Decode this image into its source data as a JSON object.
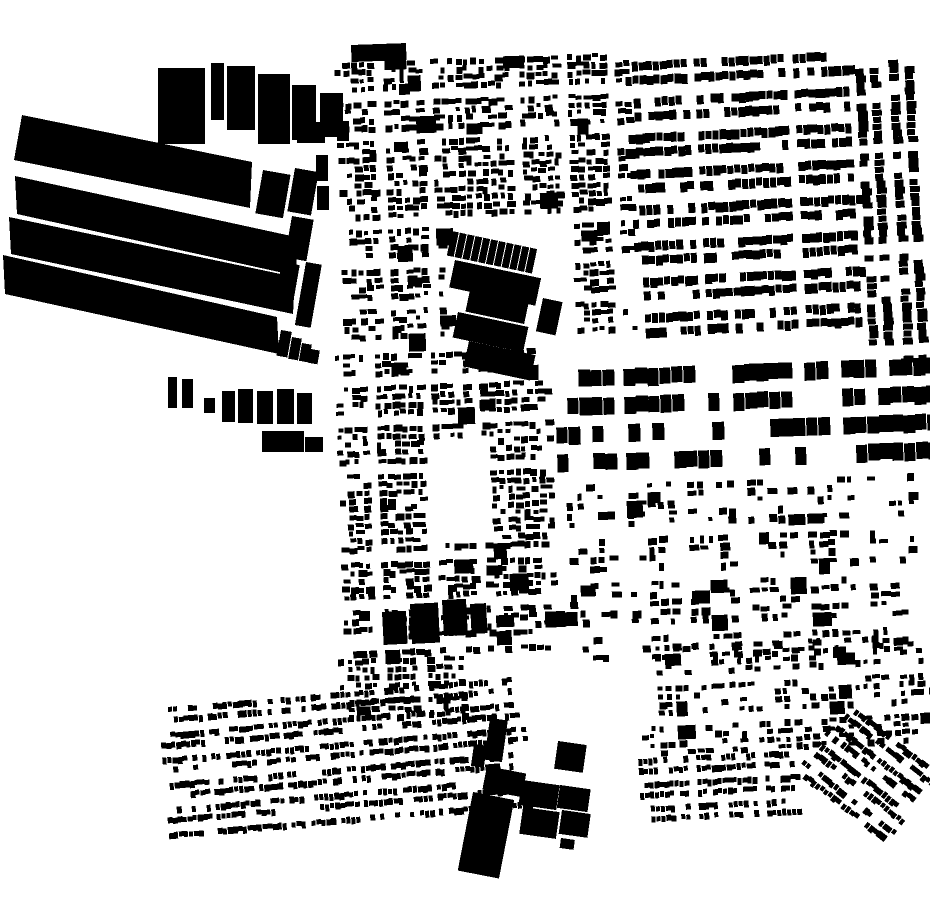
{
  "meta": {
    "description": "Black and white figure-ground map of urban building footprints",
    "background": "#ffffff",
    "building_color": "#000000",
    "width": 930,
    "height": 924
  },
  "map": {
    "districts": [
      {
        "name": "north-west-fabric",
        "type": "scatter",
        "x": 340,
        "y": 58,
        "w": 292,
        "h": 287,
        "rot": -2,
        "seed": 11,
        "holes": [
          [
            102,
            168,
            128,
            118
          ]
        ],
        "p": {
          "cell": 8,
          "cellY": 8,
          "minW": 4,
          "maxW": 9,
          "minH": 4,
          "maxH": 7,
          "fill": 0.78,
          "bigP": 0.025,
          "blockW": 40,
          "streetW": 7,
          "blockH": 34,
          "streetH": 7,
          "phaseX": 5,
          "phaseY": 3,
          "trim": 3
        }
      },
      {
        "name": "north-east-rowhouses",
        "type": "rowhouse",
        "x": 632,
        "y": 56,
        "w": 230,
        "h": 290,
        "rot": -3,
        "seed": 22,
        "p": {
          "unitW": 7,
          "stripH": 10,
          "gapA": 4,
          "gapB": 12,
          "blockW": 88,
          "streetW": 11,
          "breakP": 0.1,
          "trim": 2,
          "phaseX": 30
        }
      },
      {
        "name": "right-edge-rowhouses",
        "type": "rowhouse",
        "x": 862,
        "y": 60,
        "w": 68,
        "h": 302,
        "rot": -3,
        "seed": 33,
        "p": {
          "vertical": true,
          "unitW": 7,
          "stripH": 10,
          "gapA": 5,
          "gapB": 9,
          "blockW": 90,
          "streetW": 12,
          "breakP": 0.12,
          "trim": 2,
          "phaseX": 10
        }
      },
      {
        "name": "mid-apartment-rows",
        "type": "rowhouse",
        "x": 556,
        "y": 364,
        "w": 374,
        "h": 110,
        "rot": -2,
        "seed": 44,
        "p": {
          "unitW": 12,
          "stripH": 18,
          "gapA": 10,
          "gapB": 10,
          "blockW": 95,
          "streetW": 14,
          "breakP": 0.2,
          "trim": 1,
          "phaseX": 40
        }
      },
      {
        "name": "mid-left-fabric",
        "type": "scatter",
        "x": 340,
        "y": 352,
        "w": 214,
        "h": 300,
        "rot": -2,
        "seed": 55,
        "holes": [
          [
            86,
            82,
            60,
            102
          ]
        ],
        "p": {
          "cell": 8,
          "cellY": 8,
          "minW": 4,
          "maxW": 9,
          "minH": 4,
          "maxH": 7,
          "fill": 0.8,
          "bigP": 0.03,
          "blockW": 44,
          "streetW": 7,
          "blockH": 38,
          "streetH": 7,
          "phaseX": 12,
          "phaseY": 20,
          "trim": 2
        }
      },
      {
        "name": "mid-left-south-fabric",
        "type": "scatter",
        "x": 340,
        "y": 658,
        "w": 132,
        "h": 60,
        "rot": -2,
        "seed": 66,
        "p": {
          "cell": 8,
          "cellY": 8,
          "minW": 4,
          "maxW": 8,
          "minH": 4,
          "maxH": 7,
          "fill": 0.75,
          "bigP": 0.02,
          "blockW": 36,
          "streetW": 7,
          "blockH": 30,
          "streetH": 6,
          "phaseX": 0,
          "phaseY": 0,
          "trim": 2
        }
      },
      {
        "name": "mid-right-fabric",
        "type": "scatter",
        "x": 560,
        "y": 480,
        "w": 370,
        "h": 176,
        "rot": -2,
        "seed": 77,
        "p": {
          "cell": 10,
          "cellY": 9,
          "minW": 4,
          "maxW": 10,
          "minH": 4,
          "maxH": 8,
          "fill": 0.45,
          "bigP": 0.05,
          "blockW": 52,
          "streetW": 9,
          "blockH": 40,
          "streetH": 9,
          "phaseX": 0,
          "phaseY": 0,
          "trim": 3
        }
      },
      {
        "name": "south-rowhouse-band",
        "type": "rowhouse",
        "x": 158,
        "y": 692,
        "w": 368,
        "h": 134,
        "rot": -5,
        "seed": 88,
        "p": {
          "unitW": 5,
          "stripH": 7,
          "gapA": 3,
          "gapB": 8,
          "blockW": 66,
          "streetW": 8,
          "breakP": 0.15,
          "trim": 4,
          "phaseX": 20
        }
      },
      {
        "name": "south-right-fabric",
        "type": "scatter",
        "x": 640,
        "y": 640,
        "w": 290,
        "h": 110,
        "rot": -3,
        "seed": 99,
        "p": {
          "cell": 9,
          "cellY": 8,
          "minW": 4,
          "maxW": 8,
          "minH": 4,
          "maxH": 7,
          "fill": 0.5,
          "bigP": 0.04,
          "blockW": 46,
          "streetW": 8,
          "blockH": 34,
          "streetH": 8,
          "phaseX": 0,
          "phaseY": 4,
          "trim": 3
        }
      },
      {
        "name": "south-right-rowhouses",
        "type": "rowhouse",
        "x": 640,
        "y": 754,
        "w": 160,
        "h": 74,
        "rot": -3,
        "seed": 101,
        "p": {
          "unitW": 5,
          "stripH": 7,
          "gapA": 3,
          "gapB": 7,
          "blockW": 60,
          "streetW": 8,
          "breakP": 0.15,
          "trim": 3,
          "phaseX": 10
        }
      },
      {
        "name": "corner-rowhouses",
        "type": "rowhouse",
        "x": 806,
        "y": 728,
        "w": 118,
        "h": 100,
        "rot": 38,
        "seed": 111,
        "p": {
          "unitW": 5,
          "stripH": 7,
          "gapA": 3,
          "gapB": 7,
          "blockW": 56,
          "streetW": 7,
          "breakP": 0.15,
          "trim": 2,
          "phaseX": 5
        }
      },
      {
        "name": "dock-warehouse-slabs",
        "type": "polys",
        "polys": [
          [
            [
              22,
              115
            ],
            [
              252,
              162
            ],
            [
              250,
              208
            ],
            [
              14,
              160
            ]
          ],
          [
            [
              15,
              176
            ],
            [
              296,
              237
            ],
            [
              297,
              276
            ],
            [
              17,
              214
            ]
          ],
          [
            [
              9,
              217
            ],
            [
              295,
              277
            ],
            [
              293,
              314
            ],
            [
              11,
              254
            ]
          ],
          [
            [
              3,
              255
            ],
            [
              277,
              317
            ],
            [
              279,
              354
            ],
            [
              5,
              294
            ]
          ]
        ]
      },
      {
        "name": "warehouse-edge-blocks",
        "type": "rects",
        "rects": [
          [
            263,
            170,
            28,
            44,
            10
          ],
          [
            295,
            168,
            24,
            44,
            10
          ],
          [
            292,
            216,
            22,
            42,
            10
          ],
          [
            316,
            155,
            12,
            26,
            0
          ],
          [
            317,
            186,
            12,
            24,
            0
          ],
          [
            282,
            262,
            18,
            42,
            10
          ],
          [
            306,
            262,
            16,
            64,
            10
          ],
          [
            281,
            330,
            11,
            26,
            10
          ],
          [
            292,
            337,
            10,
            22,
            10
          ],
          [
            302,
            343,
            10,
            18,
            10
          ],
          [
            311,
            349,
            9,
            14,
            10
          ]
        ]
      },
      {
        "name": "big-box-row",
        "type": "rects",
        "rects": [
          [
            158,
            68,
            47,
            76,
            0
          ],
          [
            211,
            63,
            13,
            57,
            0
          ],
          [
            227,
            66,
            28,
            64,
            0
          ],
          [
            258,
            74,
            32,
            70,
            0
          ],
          [
            292,
            85,
            24,
            55,
            0
          ],
          [
            297,
            122,
            28,
            21,
            0
          ],
          [
            320,
            93,
            23,
            44,
            0
          ],
          [
            337,
            121,
            12,
            20,
            0
          ],
          [
            351,
            45,
            55,
            17,
            -2
          ],
          [
            384,
            54,
            22,
            16,
            -2
          ]
        ]
      },
      {
        "name": "south-of-docks-cluster",
        "type": "rects",
        "rects": [
          [
            168,
            377,
            9,
            31,
            0
          ],
          [
            182,
            379,
            11,
            29,
            0
          ],
          [
            204,
            398,
            11,
            15,
            0
          ],
          [
            222,
            391,
            13,
            31,
            0
          ],
          [
            238,
            389,
            15,
            34,
            0
          ],
          [
            257,
            391,
            16,
            33,
            0
          ],
          [
            277,
            389,
            17,
            35,
            0
          ],
          [
            297,
            393,
            15,
            31,
            0
          ],
          [
            262,
            431,
            42,
            21,
            0
          ],
          [
            305,
            437,
            18,
            15,
            0
          ]
        ]
      },
      {
        "name": "central-terrace-strip",
        "type": "units",
        "x": 452,
        "y": 231,
        "rot": 12,
        "unitW": 7,
        "unitH": 25,
        "count": 11,
        "gap": 1
      },
      {
        "name": "central-slab-cluster",
        "type": "rects",
        "rects": [
          [
            455,
            260,
            88,
            28,
            12
          ],
          [
            470,
            290,
            60,
            22,
            12
          ],
          [
            458,
            312,
            72,
            26,
            12
          ],
          [
            469,
            341,
            68,
            26,
            12
          ],
          [
            543,
            298,
            20,
            34,
            12
          ]
        ]
      },
      {
        "name": "mid-left-large-blocks",
        "type": "rects",
        "rects": [
          [
            382,
            612,
            24,
            33,
            -3
          ],
          [
            410,
            604,
            28,
            40,
            -3
          ],
          [
            442,
            600,
            24,
            36,
            -3
          ],
          [
            470,
            604,
            16,
            30,
            -3
          ]
        ]
      },
      {
        "name": "south-industrial-works",
        "type": "rects",
        "rects": [
          [
            473,
            792,
            42,
            80,
            11
          ],
          [
            487,
            766,
            40,
            24,
            11
          ],
          [
            490,
            718,
            18,
            42,
            8
          ],
          [
            474,
            744,
            13,
            22,
            8
          ],
          [
            522,
            780,
            38,
            25,
            8
          ],
          [
            523,
            807,
            37,
            27,
            8
          ],
          [
            560,
            785,
            31,
            23,
            8
          ],
          [
            562,
            810,
            29,
            24,
            8
          ],
          [
            558,
            741,
            29,
            28,
            8
          ],
          [
            561,
            838,
            14,
            10,
            8
          ]
        ]
      }
    ]
  }
}
